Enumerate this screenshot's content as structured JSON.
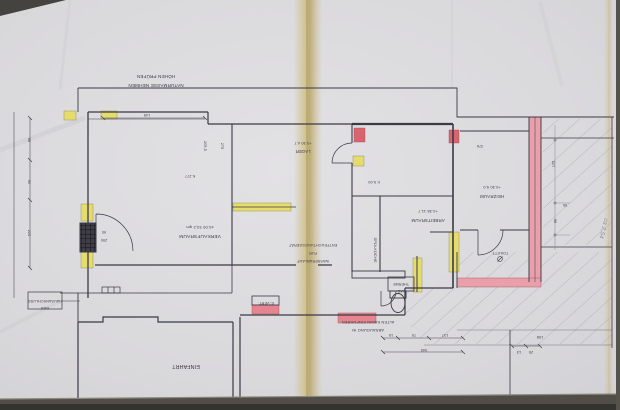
{
  "document": {
    "kind": "Gescannter Bauplan / Grundriss (um 180° gedreht eingescannt)"
  },
  "rooms": [
    {
      "name": "VERKAUFSRAUM",
      "info": "±0.00    33,2 qm"
    },
    {
      "name": "LAGER",
      "info": "+0.30   4,7"
    },
    {
      "name": "ARBEITSRAUM",
      "info": "+0.38   11,7"
    },
    {
      "name": "HEIZRAUM",
      "info": "+0.30   9,0"
    },
    {
      "name": "SPÜLKÜCHE",
      "info": ""
    },
    {
      "name": "TOILETT.",
      "info": ""
    },
    {
      "name": "EINFAHRT",
      "info": ""
    }
  ],
  "annotations": {
    "naturmasse_line1": "NATURMASSE NEHMEN",
    "naturmasse_line2": "HÖHEN PRÜFEN",
    "wasserablauf_line1": "WASSERABLAUF",
    "wasserablauf_line2": "FÜR",
    "wasserablauf_line3": "ENTFEUCHTUNGSGERÄT",
    "gastherme_line1": "GAS-",
    "gastherme_line2": "THERME",
    "evert": "E-VERT.",
    "gas_line1": "GAS",
    "gas_line2": "HAUSANSCHLUSS",
    "absaugung_line1": "ABSAUGUNG IN",
    "absaugung_line2": "ALTEN KAMIN EINFÜHREN",
    "pencil_note": "ca 2,54"
  },
  "dimensions": {
    "d145": "145",
    "d205": "205,5",
    "d275": "275",
    "k277": "K.277",
    "k500": "K 5,00",
    "d90_door": "90",
    "d290": "290",
    "d96_left": "96",
    "d90_left": "90",
    "d225_left": "225",
    "d376": "376",
    "d627": "627",
    "d90_right": "90",
    "d96_right": "96",
    "d15": "15",
    "d75": "75",
    "d137": "137",
    "d345": "345",
    "d198": "198",
    "d25": "25",
    "d13": "13"
  },
  "colors": {
    "ink": "#3b3a45",
    "pencil": "#8f8d98",
    "paper": "#d9d8db",
    "fold_yellow": "#cdbc7e",
    "highlight_yellow": "#e5dc6e",
    "highlight_pink": "#e9a0aa",
    "highlight_red": "#d86470"
  }
}
